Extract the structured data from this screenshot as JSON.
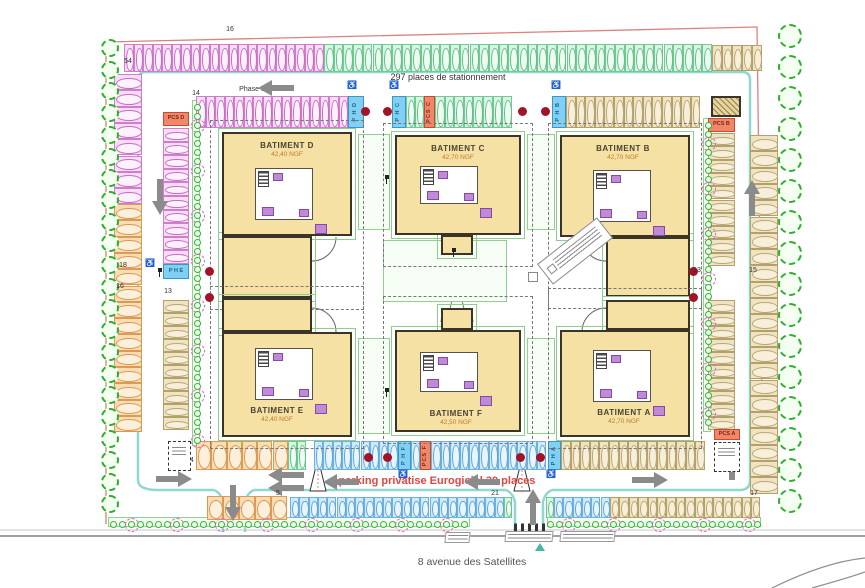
{
  "texts": {
    "phase": "Phase 3",
    "total": "297 places de stationnement",
    "private": "parking privatise Eurogiciel 30 places",
    "street": "8 avenue des Satellites"
  },
  "buildings": [
    {
      "name": "BATIMENT D",
      "elev": "42,40 NGF",
      "parts": [
        [
          222,
          132,
          130,
          104
        ],
        [
          222,
          236,
          90,
          62
        ]
      ],
      "label": [
        287,
        141
      ],
      "core": [
        255,
        168,
        58,
        52
      ]
    },
    {
      "name": "BATIMENT C",
      "elev": "42,70 NGF",
      "parts": [
        [
          395,
          135,
          126,
          100
        ],
        [
          441,
          235,
          32,
          20
        ]
      ],
      "label": [
        458,
        144
      ],
      "core": [
        420,
        166,
        58,
        38
      ]
    },
    {
      "name": "BATIMENT B",
      "elev": "42,70 NGF",
      "parts": [
        [
          560,
          135,
          130,
          102
        ],
        [
          606,
          237,
          84,
          60
        ]
      ],
      "label": [
        623,
        144
      ],
      "core": [
        593,
        170,
        58,
        52
      ]
    },
    {
      "name": "BATIMENT E",
      "elev": "42,40 NGF",
      "parts": [
        [
          222,
          332,
          130,
          105
        ],
        [
          222,
          298,
          90,
          34
        ]
      ],
      "label": [
        277,
        406
      ],
      "core": [
        255,
        348,
        58,
        52
      ]
    },
    {
      "name": "BATIMENT F",
      "elev": "42,50 NGF",
      "parts": [
        [
          395,
          330,
          126,
          102
        ],
        [
          441,
          308,
          32,
          22
        ]
      ],
      "label": [
        456,
        409
      ],
      "core": [
        420,
        352,
        58,
        40
      ]
    },
    {
      "name": "BATIMENT A",
      "elev": "42,70 NGF",
      "parts": [
        [
          560,
          330,
          130,
          107
        ],
        [
          606,
          300,
          84,
          30
        ]
      ],
      "label": [
        624,
        408
      ],
      "core": [
        593,
        350,
        58,
        52
      ]
    }
  ],
  "palette": {
    "pink": {
      "bg": "#f8def5",
      "bd": "#cf7ece",
      "ov": "#c96cc6",
      "of": "#fdf2fc"
    },
    "green": {
      "bg": "#d8f4e3",
      "bd": "#74c896",
      "ov": "#63c088",
      "of": "#eefaf2"
    },
    "tan": {
      "bg": "#efe3c3",
      "bd": "#b3a169",
      "ov": "#b9a877",
      "of": "#f7efd9"
    },
    "orange": {
      "bg": "#f6ddb5",
      "bd": "#dd9a55",
      "ov": "#dd9a55",
      "of": "#fcefdc"
    },
    "blue": {
      "bg": "#cfeafc",
      "bd": "#6fb0dc",
      "ov": "#5fa8da",
      "of": "#e8f5fe"
    },
    "pmr_bg": "#7fd0f2",
    "pmr_bd": "#3b97c9",
    "pmr_tx": "#1c5f86",
    "pcs_bg": "#f0876a",
    "pcs_bd": "#c84b2e",
    "pcs_tx": "#7d2410"
  },
  "rows": [
    {
      "x": 124,
      "y": 44,
      "dir": "h",
      "n": 21,
      "w": 9.5,
      "h": 28,
      "c": "pink"
    },
    {
      "x": 324,
      "y": 44,
      "dir": "h",
      "n": 40,
      "w": 9.7,
      "h": 28,
      "c": "green"
    },
    {
      "x": 712,
      "y": 45,
      "dir": "h",
      "n": 5,
      "w": 10,
      "h": 26,
      "c": "tan"
    },
    {
      "x": 196,
      "y": 96,
      "dir": "h",
      "n": 16,
      "w": 9.5,
      "h": 32,
      "c": "pink"
    },
    {
      "x": 406,
      "y": 96,
      "dir": "h",
      "n": 2,
      "w": 9,
      "h": 32,
      "c": "green"
    },
    {
      "x": 435,
      "y": 96,
      "dir": "h",
      "n": 8,
      "w": 9.6,
      "h": 32,
      "c": "green"
    },
    {
      "x": 566,
      "y": 96,
      "dir": "h",
      "n": 14,
      "w": 9.6,
      "h": 32,
      "c": "tan"
    },
    {
      "x": 114,
      "y": 74,
      "dir": "v",
      "n": 8,
      "w": 28,
      "h": 16.3,
      "c": "pink"
    },
    {
      "x": 114,
      "y": 204,
      "dir": "v",
      "n": 14,
      "w": 28,
      "h": 16.3,
      "c": "orange"
    },
    {
      "x": 163,
      "y": 128,
      "dir": "v",
      "n": 10,
      "w": 26,
      "h": 13.6,
      "c": "pink"
    },
    {
      "x": 163,
      "y": 300,
      "dir": "v",
      "n": 10,
      "w": 26,
      "h": 13,
      "c": "tan"
    },
    {
      "x": 750,
      "y": 135,
      "dir": "v",
      "n": 22,
      "w": 28,
      "h": 16.3,
      "c": "tan"
    },
    {
      "x": 708,
      "y": 133,
      "dir": "v",
      "n": 10,
      "w": 27,
      "h": 13.3,
      "c": "tan"
    },
    {
      "x": 708,
      "y": 300,
      "dir": "v",
      "n": 10,
      "w": 27,
      "h": 13,
      "c": "tan"
    },
    {
      "x": 196,
      "y": 441,
      "dir": "h",
      "n": 6,
      "w": 15.3,
      "h": 29,
      "c": "orange"
    },
    {
      "x": 288,
      "y": 441,
      "dir": "h",
      "n": 2,
      "w": 9,
      "h": 29,
      "c": "green"
    },
    {
      "x": 314,
      "y": 441,
      "dir": "h",
      "n": 9,
      "w": 9.3,
      "h": 29,
      "c": "blue"
    },
    {
      "x": 411,
      "y": 441,
      "dir": "h",
      "n": 1,
      "w": 9,
      "h": 29,
      "c": "blue"
    },
    {
      "x": 431,
      "y": 441,
      "dir": "h",
      "n": 12,
      "w": 9.6,
      "h": 29,
      "c": "blue"
    },
    {
      "x": 561,
      "y": 441,
      "dir": "h",
      "n": 15,
      "w": 9.6,
      "h": 29,
      "c": "tan"
    },
    {
      "x": 207,
      "y": 496,
      "dir": "h",
      "n": 5,
      "w": 16,
      "h": 24,
      "c": "orange"
    },
    {
      "x": 290,
      "y": 497,
      "dir": "h",
      "n": 23,
      "w": 9.3,
      "h": 21,
      "c": "blue"
    },
    {
      "x": 504,
      "y": 497,
      "dir": "h",
      "n": 1,
      "w": 8,
      "h": 21,
      "c": "green"
    },
    {
      "x": 546,
      "y": 497,
      "dir": "h",
      "n": 1,
      "w": 8,
      "h": 21,
      "c": "green"
    },
    {
      "x": 554,
      "y": 497,
      "dir": "h",
      "n": 6,
      "w": 9.3,
      "h": 21,
      "c": "blue"
    },
    {
      "x": 610,
      "y": 497,
      "dir": "h",
      "n": 16,
      "w": 9.4,
      "h": 21,
      "c": "tan"
    }
  ],
  "specials": [
    {
      "x": 348,
      "y": 96,
      "w": 16,
      "h": 32,
      "t": "P H D",
      "c": "pmr"
    },
    {
      "x": 392,
      "y": 96,
      "w": 14,
      "h": 32,
      "t": "P H C",
      "c": "pmr"
    },
    {
      "x": 424,
      "y": 96,
      "w": 11,
      "h": 32,
      "t": "PCS C",
      "c": "pcs"
    },
    {
      "x": 552,
      "y": 96,
      "w": 14,
      "h": 32,
      "t": "P H B",
      "c": "pmr"
    },
    {
      "x": 163,
      "y": 112,
      "w": 26,
      "h": 14,
      "t": "PCS D",
      "c": "pcs",
      "horiz": true
    },
    {
      "x": 163,
      "y": 264,
      "w": 26,
      "h": 15,
      "t": "P H E",
      "c": "pmr",
      "horiz": true
    },
    {
      "x": 708,
      "y": 118,
      "w": 27,
      "h": 14,
      "t": "PCS B",
      "c": "pcs",
      "horiz": true
    },
    {
      "x": 398,
      "y": 441,
      "w": 13,
      "h": 29,
      "t": "P H F",
      "c": "pmr"
    },
    {
      "x": 420,
      "y": 441,
      "w": 11,
      "h": 29,
      "t": "PCS F",
      "c": "pcs"
    },
    {
      "x": 548,
      "y": 441,
      "w": 13,
      "h": 29,
      "t": "P H A",
      "c": "pmr"
    },
    {
      "x": 714,
      "y": 429,
      "w": 26,
      "h": 11,
      "t": "PCS A",
      "c": "pcs",
      "horiz": true
    }
  ],
  "labels": [
    {
      "t": "16",
      "x": 230,
      "y": 26
    },
    {
      "t": "54",
      "x": 128,
      "y": 58
    },
    {
      "t": "14",
      "x": 196,
      "y": 90
    },
    {
      "t": "18",
      "x": 123,
      "y": 262
    },
    {
      "t": "16",
      "x": 120,
      "y": 283
    },
    {
      "t": "13",
      "x": 168,
      "y": 288
    },
    {
      "t": "13",
      "x": 697,
      "y": 267
    },
    {
      "t": "15",
      "x": 753,
      "y": 267
    },
    {
      "t": "14",
      "x": 190,
      "y": 457
    },
    {
      "t": "5",
      "x": 278,
      "y": 490
    },
    {
      "t": "21",
      "x": 495,
      "y": 490
    },
    {
      "t": "17",
      "x": 754,
      "y": 490
    }
  ],
  "dots": [
    [
      365,
      111
    ],
    [
      387,
      111
    ],
    [
      522,
      111
    ],
    [
      545,
      111
    ],
    [
      209,
      271
    ],
    [
      209,
      297
    ],
    [
      693,
      271
    ],
    [
      693,
      297
    ],
    [
      368,
      457
    ],
    [
      387,
      457
    ],
    [
      520,
      457
    ],
    [
      540,
      457
    ]
  ],
  "arrows": [
    {
      "x": 258,
      "y": 80,
      "r": 0
    },
    {
      "x": 142,
      "y": 189,
      "r": 270
    },
    {
      "x": 734,
      "y": 190,
      "r": 90
    },
    {
      "x": 156,
      "y": 471,
      "r": 180
    },
    {
      "x": 215,
      "y": 495,
      "r": 270
    },
    {
      "x": 268,
      "y": 467,
      "r": 0
    },
    {
      "x": 268,
      "y": 480,
      "r": 0
    },
    {
      "x": 323,
      "y": 474,
      "r": 0
    },
    {
      "x": 464,
      "y": 474,
      "r": 0
    },
    {
      "x": 515,
      "y": 499,
      "r": 90
    },
    {
      "x": 632,
      "y": 472,
      "r": 180
    },
    {
      "x": 714,
      "y": 454,
      "r": 90
    }
  ],
  "tree_strips": [
    {
      "x": 110,
      "y0": 48,
      "n": 22,
      "dy": 21.7,
      "r": 9
    },
    {
      "x": 790,
      "y0": 36,
      "n": 16,
      "dy": 31,
      "r": 12
    }
  ],
  "hedge_strips": [
    {
      "x0": 110,
      "y": 521,
      "n": 40,
      "dx": 9,
      "dir": "h"
    },
    {
      "x0": 547,
      "y": 521,
      "n": 24,
      "dx": 9,
      "dir": "h"
    },
    {
      "x0": 194,
      "y": 104,
      "n": 38,
      "dx": 9,
      "dir": "v"
    },
    {
      "x0": 705,
      "y": 122,
      "n": 34,
      "dx": 9,
      "dir": "v"
    }
  ],
  "green_rects": [
    [
      358,
      134,
      32,
      96
    ],
    [
      527,
      134,
      28,
      96
    ],
    [
      358,
      338,
      32,
      96
    ],
    [
      527,
      338,
      28,
      96
    ],
    [
      383,
      240,
      124,
      62
    ],
    [
      192,
      100,
      8,
      346
    ],
    [
      703,
      118,
      8,
      314
    ],
    [
      108,
      517,
      362,
      10
    ],
    [
      547,
      517,
      214,
      10
    ]
  ],
  "boxes": [
    {
      "x": 711,
      "y": 96,
      "w": 30,
      "h": 21,
      "k": "hatch"
    },
    {
      "x": 168,
      "y": 441,
      "w": 23,
      "h": 30,
      "k": "local"
    },
    {
      "x": 714,
      "y": 442,
      "w": 26,
      "h": 30,
      "k": "local"
    }
  ],
  "wheelchairs": [
    [
      352,
      85
    ],
    [
      394,
      85
    ],
    [
      556,
      85
    ],
    [
      403,
      474
    ],
    [
      551,
      474
    ],
    [
      150,
      263
    ]
  ],
  "lamps": [
    [
      158,
      268
    ],
    [
      385,
      175
    ],
    [
      385,
      388
    ],
    [
      452,
      248
    ]
  ],
  "entrance_notes": [
    {
      "x": 445,
      "y": 532,
      "w": 25
    },
    {
      "x": 505,
      "y": 531,
      "w": 48
    },
    {
      "x": 560,
      "y": 531,
      "w": 55
    }
  ],
  "note": {
    "x": 537,
    "y": 238,
    "w": 74,
    "h": 24
  }
}
